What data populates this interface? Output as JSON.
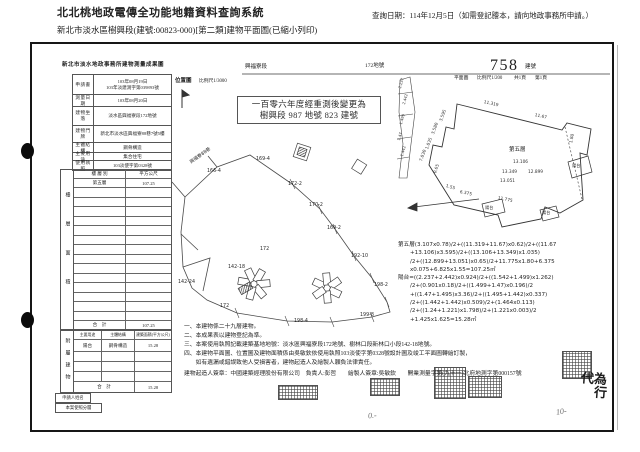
{
  "header": {
    "title": "北北桃地政電傳全功能地籍資料查詢系統",
    "query_date": "查詢日期：114年12月5日（如需登記謄本，請向地政事務所申請。）",
    "subtitle": "新北市淡水區樹興段(建號:00823-000)[第二類]建物平面圖(已縮小列印)"
  },
  "doc_header": {
    "form_title": "新北市淡水地政事務所建物測量成果圖",
    "section": "興福寮段",
    "parcel": "172地號",
    "bldg_no": "758",
    "bldg_no_label": "建號",
    "plan": "平面圖",
    "plan_scale": "比例尺1/200",
    "pages": "共1頁",
    "page": "第1頁",
    "loc": "位置圖",
    "loc_scale": "比例尺1/3000"
  },
  "remeasure_stamp": {
    "line1": "一百零六年度經重測後變更為",
    "line2": "樹興段 987 地號 823 建號"
  },
  "form": {
    "rows": [
      {
        "label": "申請書",
        "v1": "103年08月19日",
        "v2": "103年淡建測字第039893號"
      },
      {
        "label": "測量日期",
        "v1": "103年08月20日"
      },
      {
        "label": "建物坐落",
        "v1": "淡水區興福寮段172地號"
      },
      {
        "label": "建物門牌",
        "v1": "新北市淡水區興福寮88巷7號5樓"
      },
      {
        "label": "主體結構",
        "v1": "鋼骨構造"
      },
      {
        "label": "主要用途",
        "v1": "集合住宅"
      },
      {
        "label": "使用執照",
        "v1": "103淡使字第0328號"
      }
    ],
    "floor": {
      "side": "樓層面積",
      "h1": "樓 層 別",
      "h2": "平方公尺",
      "r1c1": "第五層",
      "r1c2": "107.25",
      "total_label": "合　計",
      "total": "107.25"
    },
    "annex": {
      "side": "附屬建物",
      "h1": "主要用途",
      "h2": "主體結構",
      "h3": "建築面積(平方公尺)",
      "r1c1": "陽台",
      "r1c2": "鋼骨構造",
      "r1c3": "15.28",
      "total_label": "合　計",
      "total": "15.28"
    },
    "applicant": "申請人姓名",
    "approval": "本案使照分層"
  },
  "map": {
    "road": "興福寮88巷",
    "labels": [
      "166-4",
      "169-4",
      "172-2",
      "170-2",
      "169-2",
      "172",
      "192-10",
      "142-18",
      "142-24",
      "198-2",
      "172",
      "198-4",
      "199-8"
    ]
  },
  "plan": {
    "floor_label": "第五層",
    "balcony": "陽台",
    "dims": [
      "11.319",
      "11.67",
      "3.595",
      "3.580",
      "1.035",
      "7.030",
      "0.65",
      "1.55",
      "6.375",
      "11.775",
      "13.106",
      "13.349",
      "12.899",
      "13.051",
      "1.80"
    ],
    "balcony_dims": [
      "2.237",
      "2.442",
      "1.499",
      "1.47",
      "1.442"
    ]
  },
  "calc": {
    "lines": [
      "第五層(3.107x0.78)/2+((11.319+11.67)x0.62)/2+((11.67",
      "+13.106)x3.595)/2+((13.106+13.349)x1.035)",
      "/2+((12.899+13.051)x0.65)/2+11.775x1.80+6.375",
      "x0.075+6.825x1.55=107.25㎡",
      "陽台=((2.237+2.442)x0.924)/2+((1.542+1.499)x1.262)",
      "/2+(0.901x0.18)/2+((1.499+1.47)x0.196)/2",
      "+((1.47+1.495)x3.36)/2+((1.495+1.442)x0.337)",
      "/2+((1.442+1.442)x0.509)/2+(1.464x0.113)",
      "/2+((1.24+1.221)x1.798)/2+(1.221x0.003)/2",
      "+1.425x1.625=15.28㎡"
    ]
  },
  "notes": {
    "lines": [
      "一、本建物係二十九層建物。",
      "二、本成果表以建物登記為準。",
      "三、本案使用執照記載建築基地地號：淡水區興福寮段172地號、樹林口段新林口小段142-18地號。",
      "四、本建物平面圖、位置圖及建物面積係由吳敏欽依使用執照103淡使字第0328號設計圖及竣工平面圖轉繪訂製，",
      "　　如有遺漏或錯誤致他人受損害者，建物起造人及繪製人願負法律責任。"
    ],
    "sign": "建物起造人簽章：中國建築經理股份有限公司　負責人:彭哲　　繪製人簽章:吳敏欽　　開業測量字第(九十一)北府地測字第000157號"
  },
  "annotations": {
    "hw1": "代為",
    "hw2": "行",
    "scribble1": "0.-",
    "scribble2": "10-"
  }
}
